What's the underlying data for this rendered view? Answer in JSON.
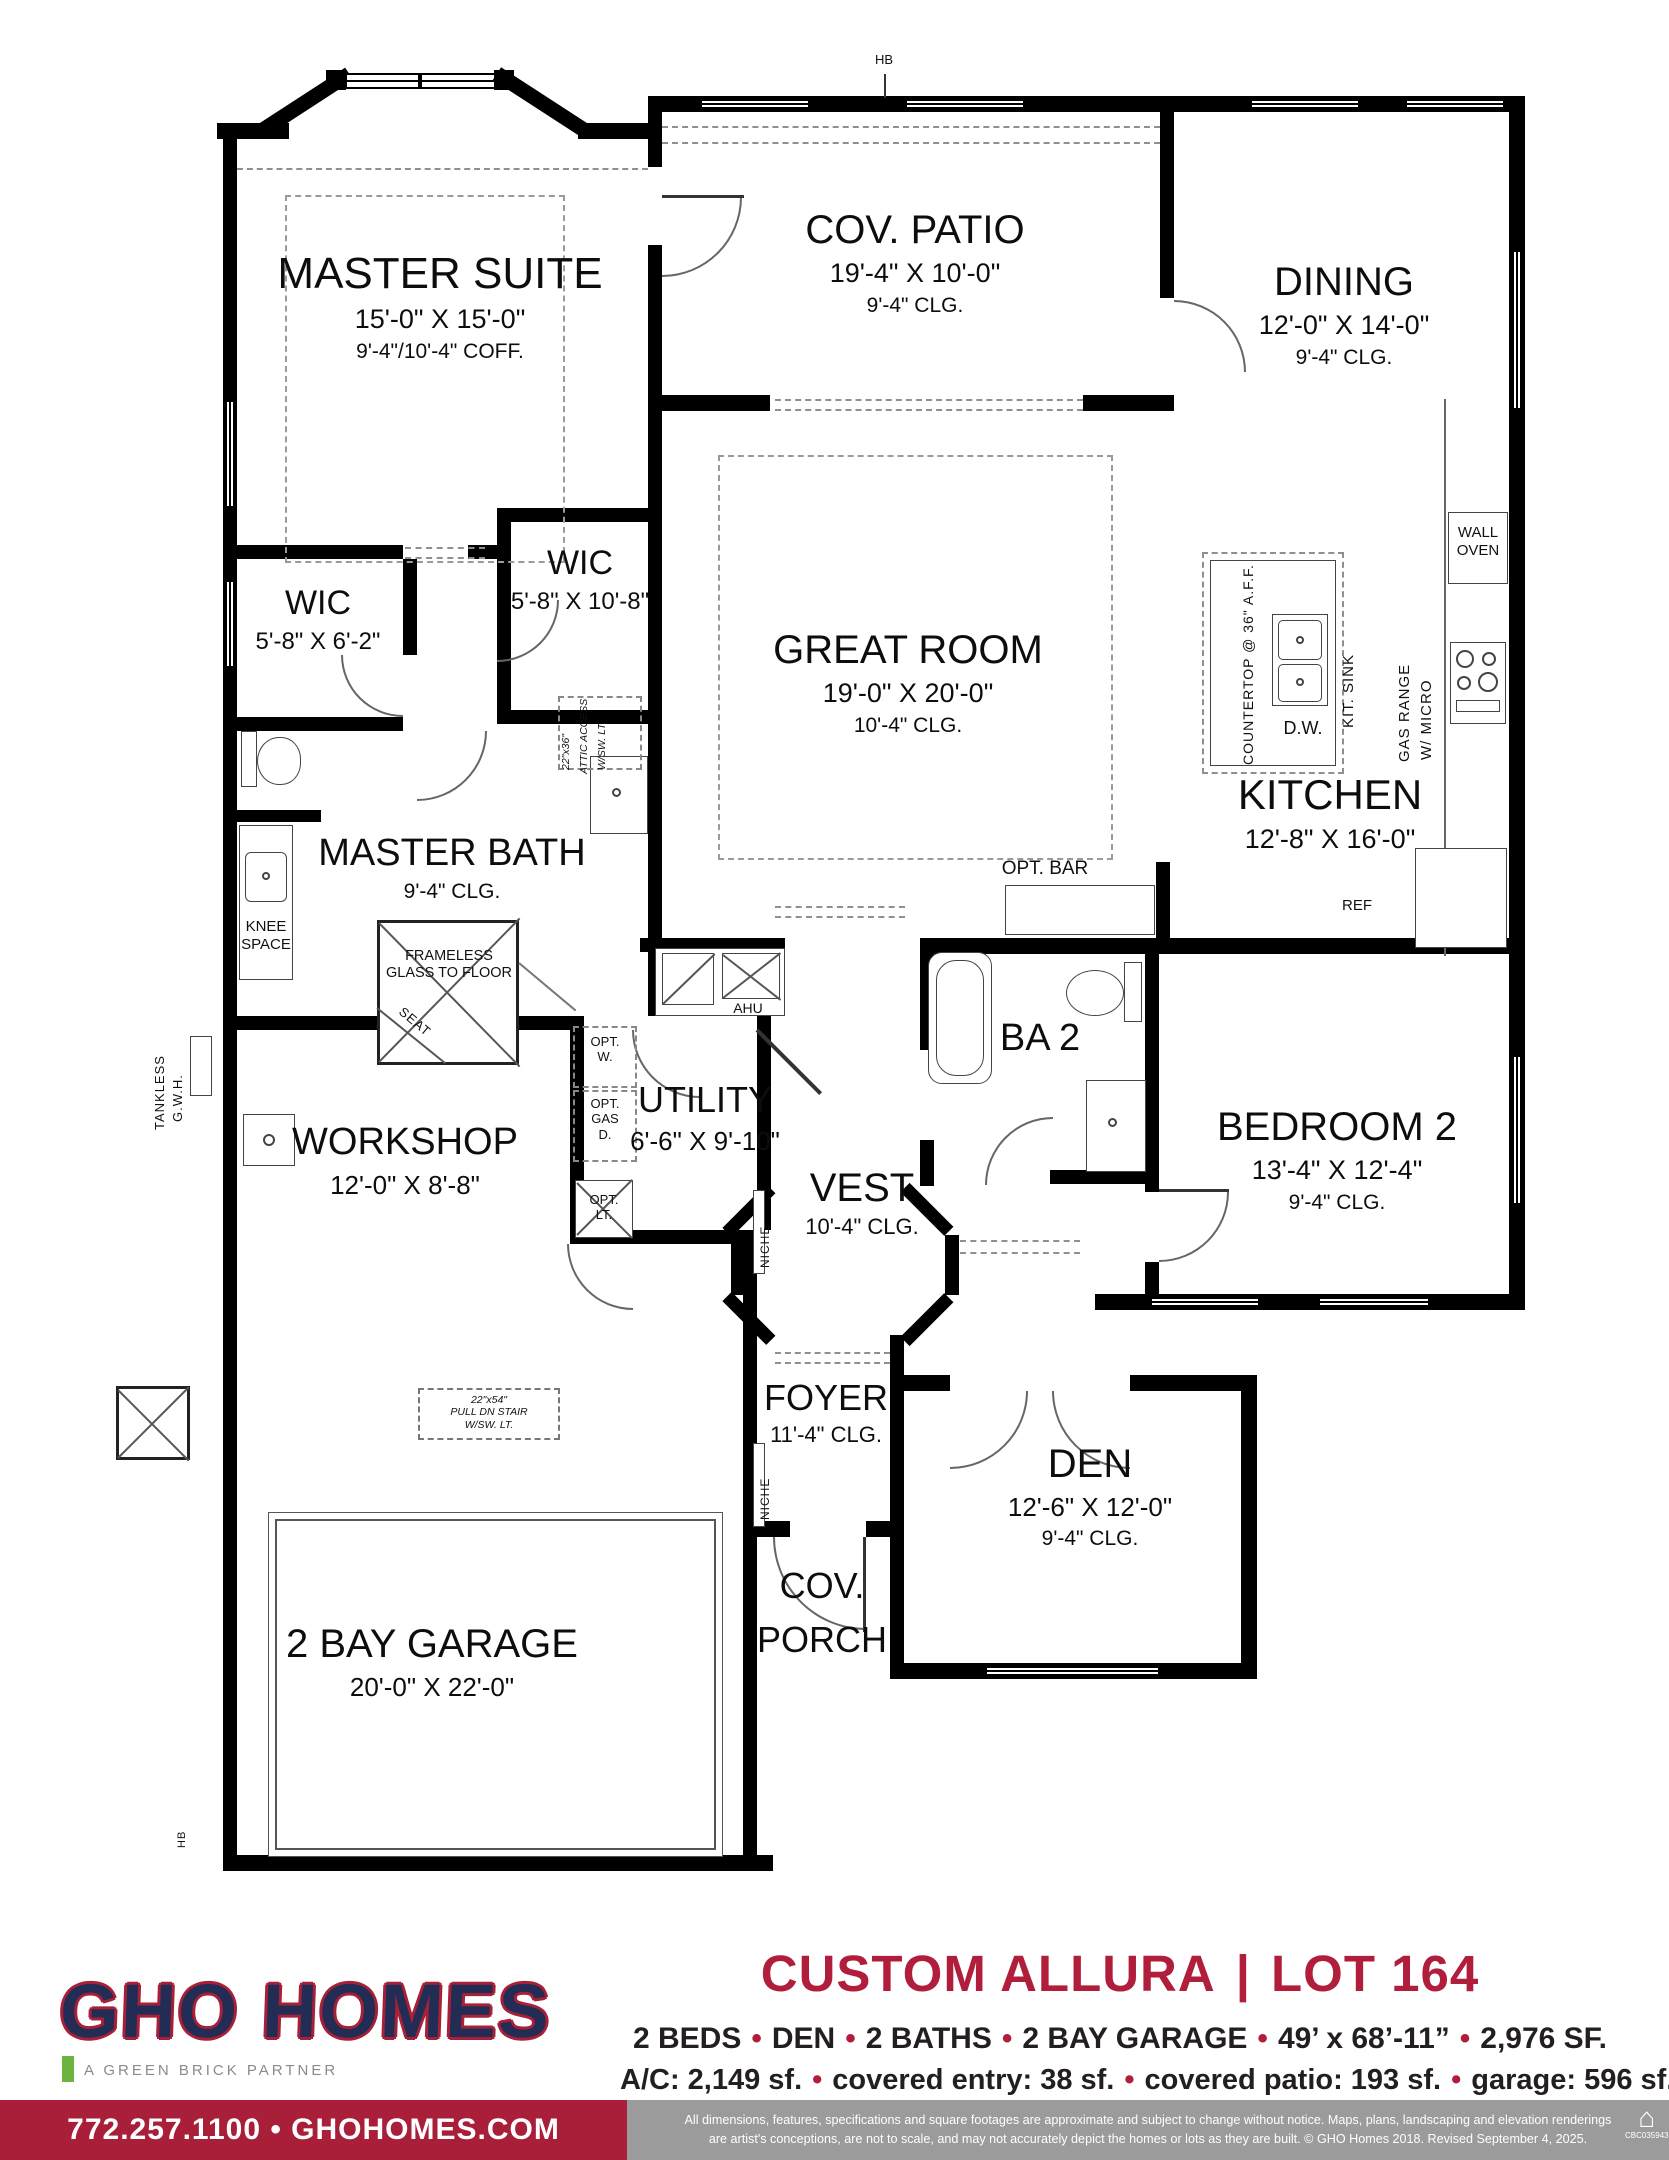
{
  "rooms": [
    {
      "n": "MASTER SUITE",
      "d": "15'-0\" X 15'-0\"",
      "c": "9'-4\"/10'-4\" COFF."
    },
    {
      "n": "COV. PATIO",
      "d": "19'-4\" X 10'-0\"",
      "c": "9'-4\" CLG."
    },
    {
      "n": "DINING",
      "d": "12'-0\" X 14'-0\"",
      "c": "9'-4\" CLG."
    },
    {
      "n": "WIC",
      "d": "5'-8\" X 6'-2\""
    },
    {
      "n": "WIC",
      "d": "5'-8\" X 10'-8\""
    },
    {
      "n": "GREAT ROOM",
      "d": "19'-0\" X 20'-0\"",
      "c": "10'-4\" CLG."
    },
    {
      "n": "KITCHEN",
      "d": "12'-8\" X 16'-0\""
    },
    {
      "n": "MASTER BATH",
      "c": "9'-4\" CLG."
    },
    {
      "n": "WORKSHOP",
      "d": "12'-0\" X 8'-8\""
    },
    {
      "n": "UTILITY",
      "d": "6'-6\" X 9'-10\""
    },
    {
      "n": "VEST",
      "c": "10'-4\" CLG."
    },
    {
      "n": "BA 2"
    },
    {
      "n": "BEDROOM 2",
      "d": "13'-4\" X 12'-4\"",
      "c": "9'-4\" CLG."
    },
    {
      "n": "FOYER",
      "c": "11'-4\" CLG."
    },
    {
      "n": "DEN",
      "d": "12'-6\" X 12'-0\"",
      "c": "9'-4\" CLG."
    },
    {
      "n1": "COV.",
      "n2": "PORCH"
    },
    {
      "n": "2 BAY GARAGE",
      "d": "20'-0\" X 22'-0\""
    }
  ],
  "ann": {
    "hb": "HB",
    "wall_oven_1": "WALL",
    "wall_oven_2": "OVEN",
    "gas_range_1": "GAS RANGE",
    "gas_range_2": "W/ MICRO",
    "kit_sink": "KIT. SINK",
    "countertop": "COUNTERTOP @ 36\" A.F.F.",
    "dw": "D.W.",
    "ref": "REF",
    "opt_bar": "OPT. BAR",
    "attic_1": "22\"x36\"",
    "attic_2": "ATTIC ACCESS",
    "attic_3": "W/SW. LT.",
    "knee_1": "KNEE",
    "knee_2": "SPACE",
    "frameless_1": "FRAMELESS",
    "frameless_2": "GLASS TO FLOOR",
    "seat": "SEAT",
    "tankless_1": "TANKLESS",
    "tankless_2": "G.W.H.",
    "ahu": "AHU",
    "opt_w_1": "OPT.",
    "opt_w_2": "W.",
    "opt_gas_1": "OPT.",
    "opt_gas_2": "GAS",
    "opt_gas_3": "D.",
    "opt_lt_1": "OPT.",
    "opt_lt_2": "LT.",
    "niche": "NICHE",
    "stair_1": "22\"x54\"",
    "stair_2": "PULL DN STAIR",
    "stair_3": "W/SW. LT."
  },
  "footer": {
    "logo": "GHO HOMES",
    "tagline": "A GREEN BRICK PARTNER",
    "plan_name": "CUSTOM ALLURA",
    "divider": "|",
    "lot": "LOT 164",
    "bullet": "•",
    "stats1": [
      "2 BEDS",
      "DEN",
      "2 BATHS",
      "2 BAY GARAGE",
      "49’ x 68’-11”",
      "2,976 SF."
    ],
    "stats2": [
      "A/C: 2,149 sf.",
      "covered entry: 38 sf.",
      "covered patio: 193 sf.",
      "garage: 596 sf."
    ],
    "contact": "772.257.1100 • GHOHOMES.COM",
    "disclaimer_1": "All dimensions, features, specifications and square footages are approximate and subject to change without notice. Maps, plans, landscaping and elevation renderings",
    "disclaimer_2": "are artist's conceptions, are not to scale, and may not accurately depict the homes or lots as they are built. © GHO Homes 2018. Revised September 4, 2025.",
    "license": "CBC035943"
  },
  "colors": {
    "accent": "#b01e3c",
    "logo_navy": "#232c54",
    "green": "#6cb33f",
    "gray_bar": "#9b9b9b"
  }
}
